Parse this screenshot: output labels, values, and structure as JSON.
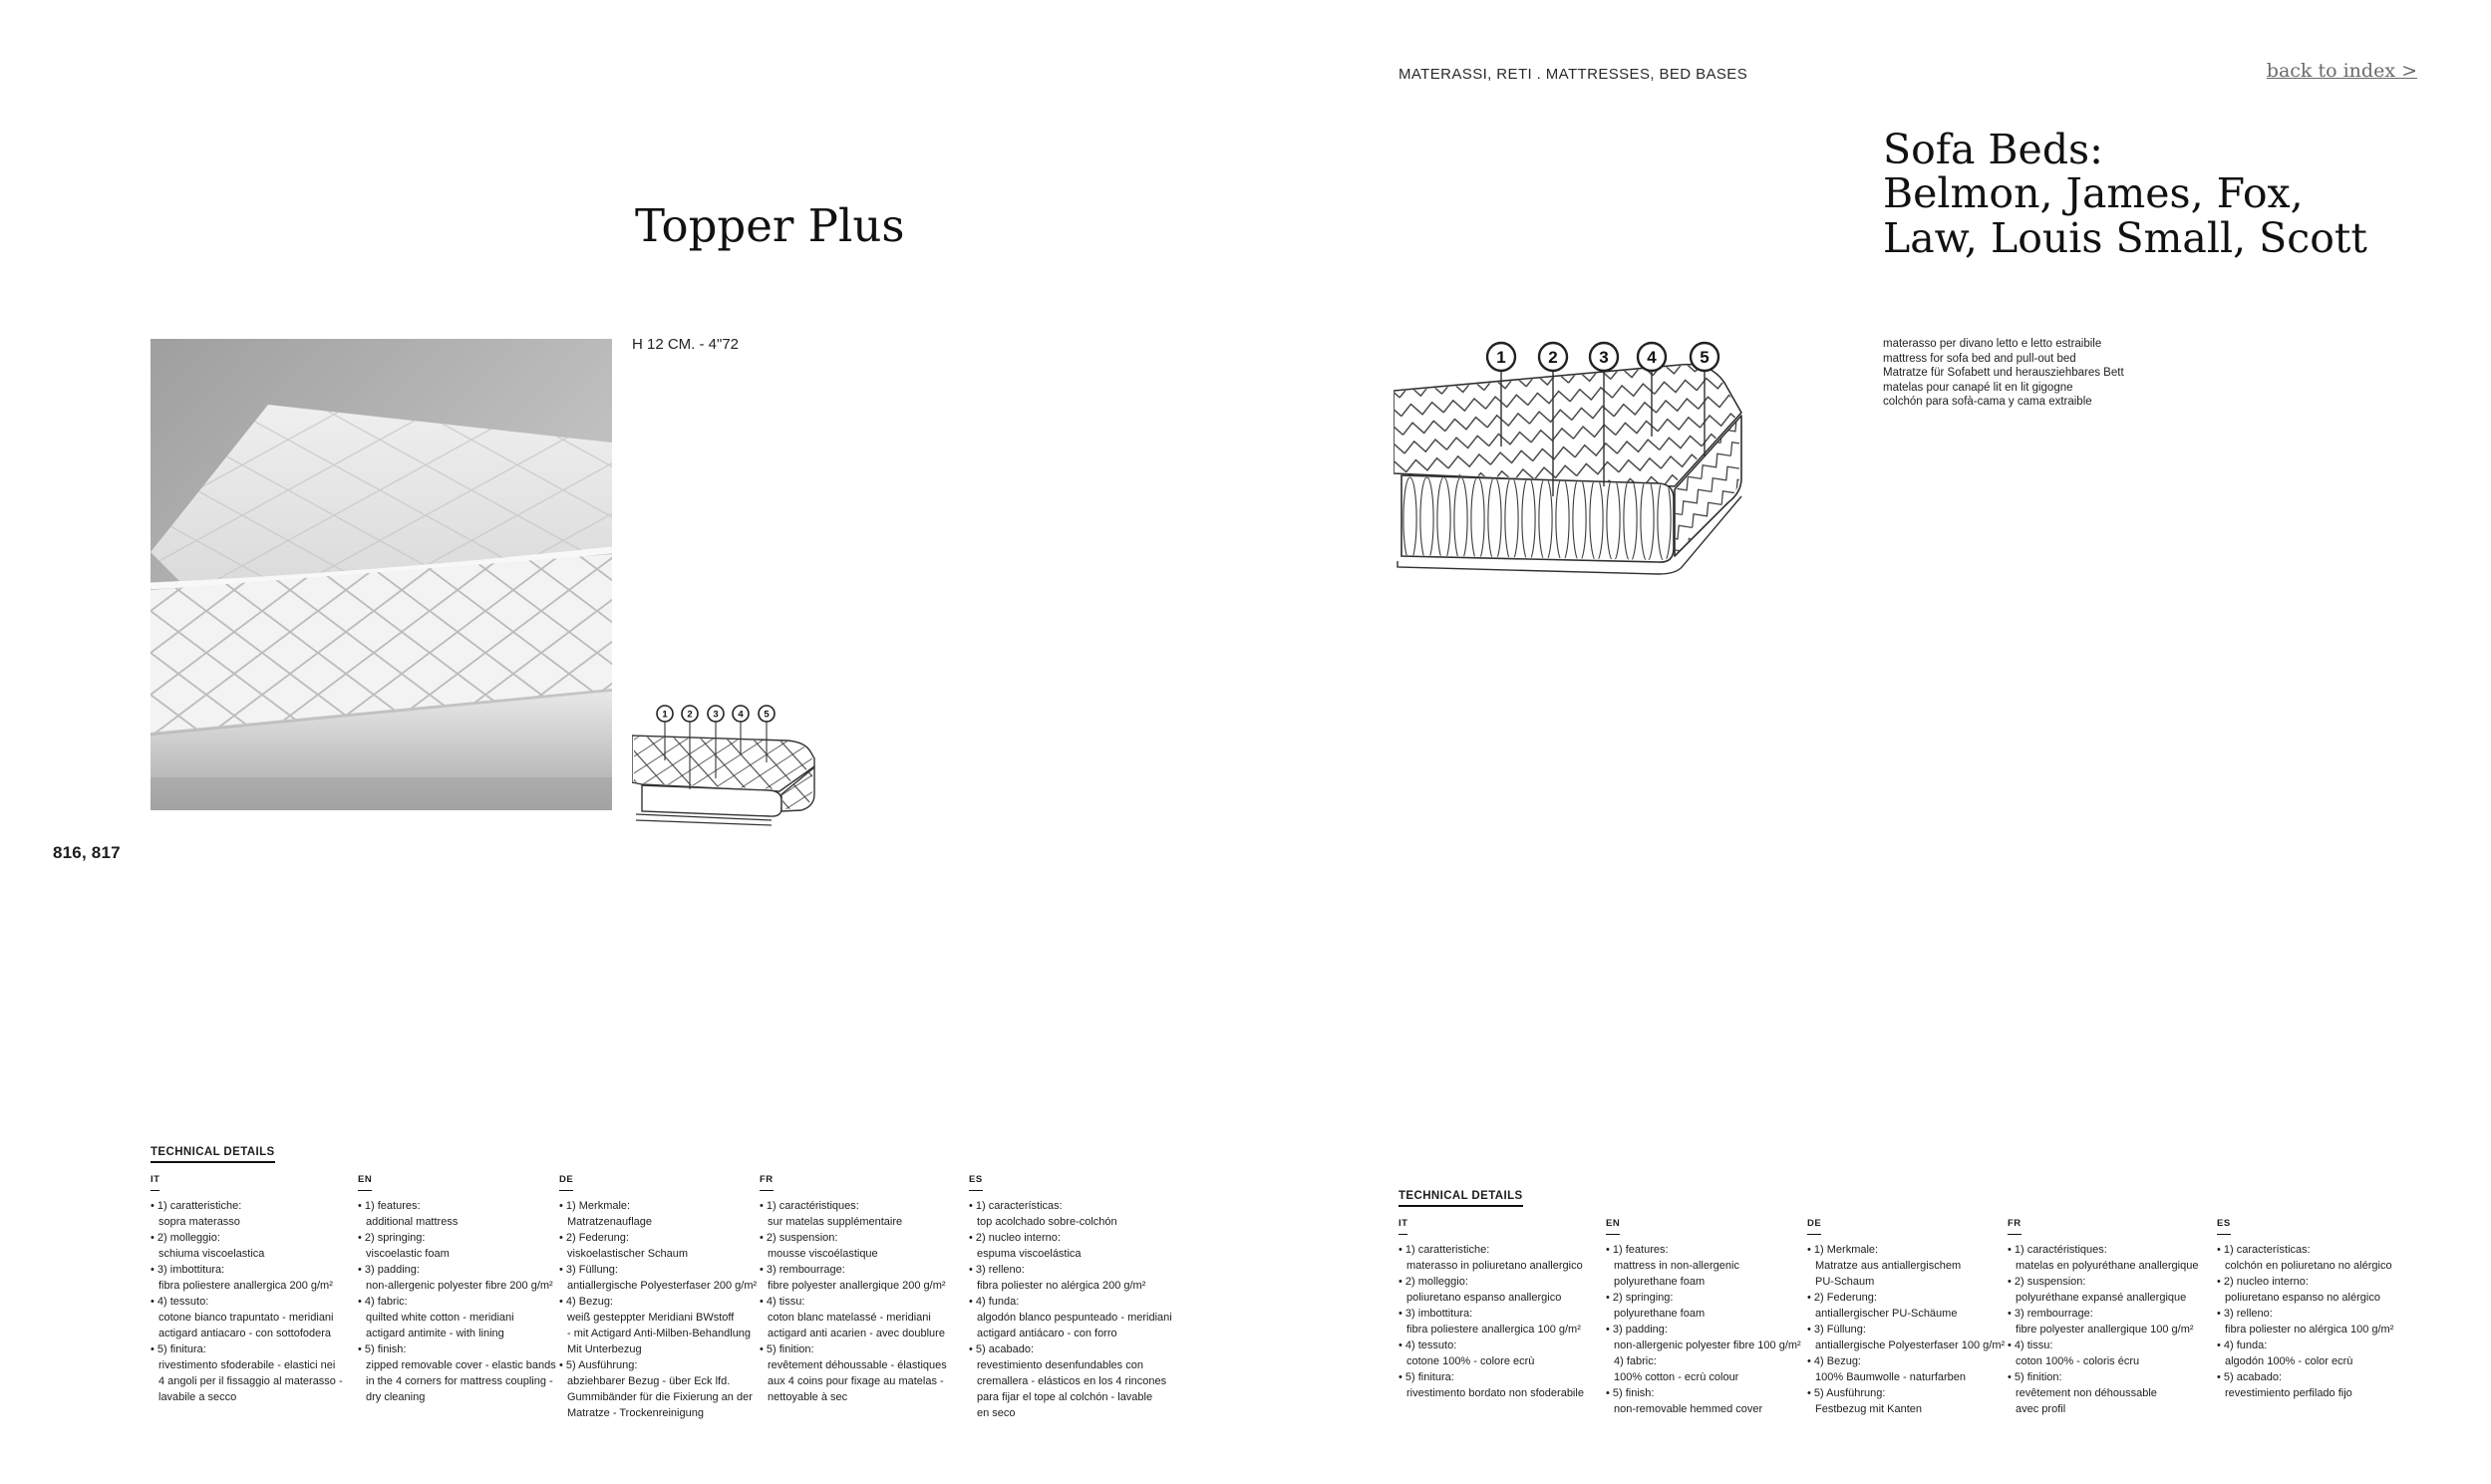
{
  "page": {
    "category_header": "MATERASSI, RETI . MATTRESSES, BED BASES",
    "back_link": "back to index >",
    "page_numbers": "816, 817"
  },
  "colors": {
    "text": "#1d1d1d",
    "link_gray": "#6a6a6a",
    "diagram_stroke": "#2f2f2f",
    "photo_gray": "#c9c9c9"
  },
  "left_product": {
    "title": "Topper Plus",
    "height_note": "H 12 CM. - 4\"72",
    "diagram_callouts": [
      "1",
      "2",
      "3",
      "4",
      "5"
    ]
  },
  "right_product": {
    "title_lines": [
      "Sofa Beds:",
      "Belmon, James, Fox,",
      "Law, Louis Small, Scott"
    ],
    "description_lines": [
      "materasso per divano letto e letto estraibile",
      "mattress for sofa bed and pull-out bed",
      "Matratze für Sofabett und herausziehbares Bett",
      "matelas pour canapé lit en lit gigogne",
      "colchón para sofà-cama y cama extraible"
    ],
    "diagram_callouts": [
      "1",
      "2",
      "3",
      "4",
      "5"
    ]
  },
  "tech_left": {
    "heading": "TECHNICAL DETAILS",
    "columns": [
      {
        "lang": "IT",
        "items": [
          {
            "bullet": "•",
            "head": "1) caratteristiche:",
            "lines": [
              "sopra materasso"
            ]
          },
          {
            "bullet": "•",
            "head": "2) molleggio:",
            "lines": [
              "schiuma viscoelastica"
            ]
          },
          {
            "bullet": "•",
            "head": "3) imbottitura:",
            "lines": [
              "fibra poliestere anallergica 200 g/m²"
            ]
          },
          {
            "bullet": "•",
            "head": "4) tessuto:",
            "lines": [
              "cotone bianco trapuntato - meridiani",
              "actigard antiacaro - con sottofodera"
            ]
          },
          {
            "bullet": "•",
            "head": "5) finitura:",
            "lines": [
              "rivestimento sfoderabile - elastici nei",
              "4 angoli per il fissaggio al materasso -",
              "lavabile a secco"
            ]
          }
        ]
      },
      {
        "lang": "EN",
        "items": [
          {
            "bullet": "•",
            "head": "1) features:",
            "lines": [
              "additional mattress"
            ]
          },
          {
            "bullet": "•",
            "head": "2) springing:",
            "lines": [
              "viscoelastic foam"
            ]
          },
          {
            "bullet": "•",
            "head": "3) padding:",
            "lines": [
              "non-allergenic polyester fibre 200 g/m²"
            ]
          },
          {
            "bullet": "•",
            "head": "4) fabric:",
            "lines": [
              "quilted white cotton - meridiani",
              "actigard antimite - with lining"
            ]
          },
          {
            "bullet": "•",
            "head": "5) finish:",
            "lines": [
              "zipped removable cover - elastic bands",
              "in the 4 corners for mattress coupling -",
              "dry cleaning"
            ]
          }
        ]
      },
      {
        "lang": "DE",
        "items": [
          {
            "bullet": "•",
            "head": "1) Merkmale:",
            "lines": [
              "Matratzenauflage"
            ]
          },
          {
            "bullet": "•",
            "head": "2) Federung:",
            "lines": [
              "viskoelastischer Schaum"
            ]
          },
          {
            "bullet": "•",
            "head": "3) Füllung:",
            "lines": [
              "antiallergische Polyesterfaser 200 g/m²"
            ]
          },
          {
            "bullet": "•",
            "head": "4) Bezug:",
            "lines": [
              "weiß gesteppter Meridiani BWstoff",
              "- mit Actigard Anti-Milben-Behandlung",
              "Mit Unterbezug"
            ]
          },
          {
            "bullet": "•",
            "head": "5) Ausführung:",
            "lines": [
              "abziehbarer Bezug - über Eck lfd.",
              "Gummibänder für die Fixierung an der",
              "Matratze - Trockenreinigung"
            ]
          }
        ]
      },
      {
        "lang": "FR",
        "items": [
          {
            "bullet": "•",
            "head": "1) caractéristiques:",
            "lines": [
              "sur matelas supplémentaire"
            ]
          },
          {
            "bullet": "•",
            "head": "2) suspension:",
            "lines": [
              "mousse viscoélastique"
            ]
          },
          {
            "bullet": "•",
            "head": "3) rembourrage:",
            "lines": [
              "fibre polyester anallergique 200 g/m²"
            ]
          },
          {
            "bullet": "•",
            "head": "4) tissu:",
            "lines": [
              "coton blanc matelassé - meridiani",
              "actigard anti acarien - avec doublure"
            ]
          },
          {
            "bullet": "•",
            "head": "5) finition:",
            "lines": [
              "revêtement déhoussable - élastiques",
              "aux 4 coins pour fixage au matelas -",
              "nettoyable à sec"
            ]
          }
        ]
      },
      {
        "lang": "ES",
        "items": [
          {
            "bullet": "•",
            "head": "1) características:",
            "lines": [
              "top acolchado sobre-colchón"
            ]
          },
          {
            "bullet": "•",
            "head": "2) nucleo interno:",
            "lines": [
              "espuma viscoelástica"
            ]
          },
          {
            "bullet": "•",
            "head": "3) relleno:",
            "lines": [
              "fibra poliester no alérgica 200 g/m²"
            ]
          },
          {
            "bullet": "•",
            "head": "4) funda:",
            "lines": [
              "algodón blanco pespunteado - meridiani",
              "actigard antiácaro - con forro"
            ]
          },
          {
            "bullet": "•",
            "head": "5) acabado:",
            "lines": [
              "revestimiento desenfundables con",
              "cremallera - elásticos en los 4 rincones",
              "para fijar el tope al colchón - lavable",
              "en seco"
            ]
          }
        ]
      }
    ]
  },
  "tech_right": {
    "heading": "TECHNICAL DETAILS",
    "columns": [
      {
        "lang": "IT",
        "items": [
          {
            "bullet": "•",
            "head": "1) caratteristiche:",
            "lines": [
              "materasso in poliuretano anallergico"
            ]
          },
          {
            "bullet": "•",
            "head": "2) molleggio:",
            "lines": [
              "poliuretano espanso anallergico"
            ]
          },
          {
            "bullet": "•",
            "head": "3) imbottitura:",
            "lines": [
              "fibra poliestere anallergica 100 g/m²"
            ]
          },
          {
            "bullet": "•",
            "head": "4) tessuto:",
            "lines": [
              "cotone 100% - colore ecrù"
            ]
          },
          {
            "bullet": "•",
            "head": "5) finitura:",
            "lines": [
              "rivestimento bordato non sfoderabile"
            ]
          }
        ]
      },
      {
        "lang": "EN",
        "items": [
          {
            "bullet": "•",
            "head": "1) features:",
            "lines": [
              "mattress in non-allergenic",
              "polyurethane foam"
            ]
          },
          {
            "bullet": "•",
            "head": "2) springing:",
            "lines": [
              "polyurethane foam"
            ]
          },
          {
            "bullet": "•",
            "head": "3) padding:",
            "lines": [
              "non-allergenic polyester fibre 100 g/m²"
            ]
          },
          {
            "bullet": "",
            "head": "4) fabric:",
            "lines": [
              "100% cotton - ecrù colour"
            ]
          },
          {
            "bullet": "•",
            "head": "5) finish:",
            "lines": [
              "non-removable hemmed cover"
            ]
          }
        ]
      },
      {
        "lang": "DE",
        "items": [
          {
            "bullet": "•",
            "head": "1) Merkmale:",
            "lines": [
              "Matratze aus antiallergischem",
              "PU-Schaum"
            ]
          },
          {
            "bullet": "•",
            "head": "2) Federung:",
            "lines": [
              "antiallergischer PU-Schäume"
            ]
          },
          {
            "bullet": "•",
            "head": "3) Füllung:",
            "lines": [
              "antiallergische Polyesterfaser 100 g/m²"
            ]
          },
          {
            "bullet": "•",
            "head": "4) Bezug:",
            "lines": [
              "100% Baumwolle - naturfarben"
            ]
          },
          {
            "bullet": "•",
            "head": "5) Ausführung:",
            "lines": [
              "Festbezug mit Kanten"
            ]
          }
        ]
      },
      {
        "lang": "FR",
        "items": [
          {
            "bullet": "•",
            "head": "1) caractéristiques:",
            "lines": [
              "matelas en polyuréthane anallergique"
            ]
          },
          {
            "bullet": "•",
            "head": "2) suspension:",
            "lines": [
              "polyuréthane expansé anallergique"
            ]
          },
          {
            "bullet": "•",
            "head": "3) rembourrage:",
            "lines": [
              "fibre polyester anallergique 100 g/m²"
            ]
          },
          {
            "bullet": "•",
            "head": "4) tissu:",
            "lines": [
              "coton 100% - coloris écru"
            ]
          },
          {
            "bullet": "•",
            "head": "5) finition:",
            "lines": [
              "revêtement non déhoussable",
              "avec profil"
            ]
          }
        ]
      },
      {
        "lang": "ES",
        "items": [
          {
            "bullet": "•",
            "head": "1) características:",
            "lines": [
              "colchón en poliuretano no alérgico"
            ]
          },
          {
            "bullet": "•",
            "head": "2) nucleo interno:",
            "lines": [
              "poliuretano espanso no alérgico"
            ]
          },
          {
            "bullet": "•",
            "head": "3) relleno:",
            "lines": [
              "fibra poliester no alérgica 100 g/m²"
            ]
          },
          {
            "bullet": "•",
            "head": "4) funda:",
            "lines": [
              "algodón 100% - color ecrù"
            ]
          },
          {
            "bullet": "•",
            "head": "5) acabado:",
            "lines": [
              "revestimiento perfilado fijo"
            ]
          }
        ]
      }
    ]
  }
}
